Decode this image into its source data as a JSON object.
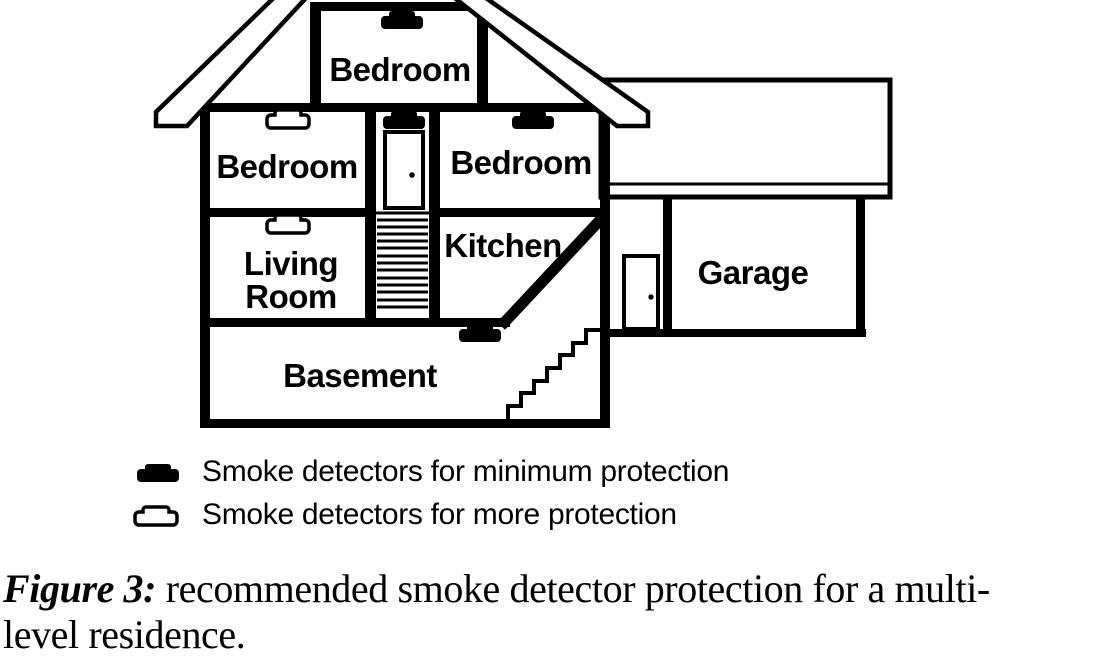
{
  "diagram": {
    "rooms": {
      "attic_bedroom": "Bedroom",
      "left_bedroom": "Bedroom",
      "right_bedroom": "Bedroom",
      "kitchen": "Kitchen",
      "living_room_line1": "Living",
      "living_room_line2": "Room",
      "basement": "Basement",
      "garage": "Garage"
    }
  },
  "legend": {
    "items": [
      {
        "icon": "filled-detector-icon",
        "label": "Smoke detectors for minimum protection"
      },
      {
        "icon": "outline-detector-icon",
        "label": "Smoke detectors for more protection"
      }
    ]
  },
  "caption": {
    "label": "Figure 3:",
    "line1": "recommended smoke detector protection for a multi-",
    "line2": "level residence."
  },
  "colors": {
    "ink": "#000000",
    "background": "#ffffff"
  }
}
